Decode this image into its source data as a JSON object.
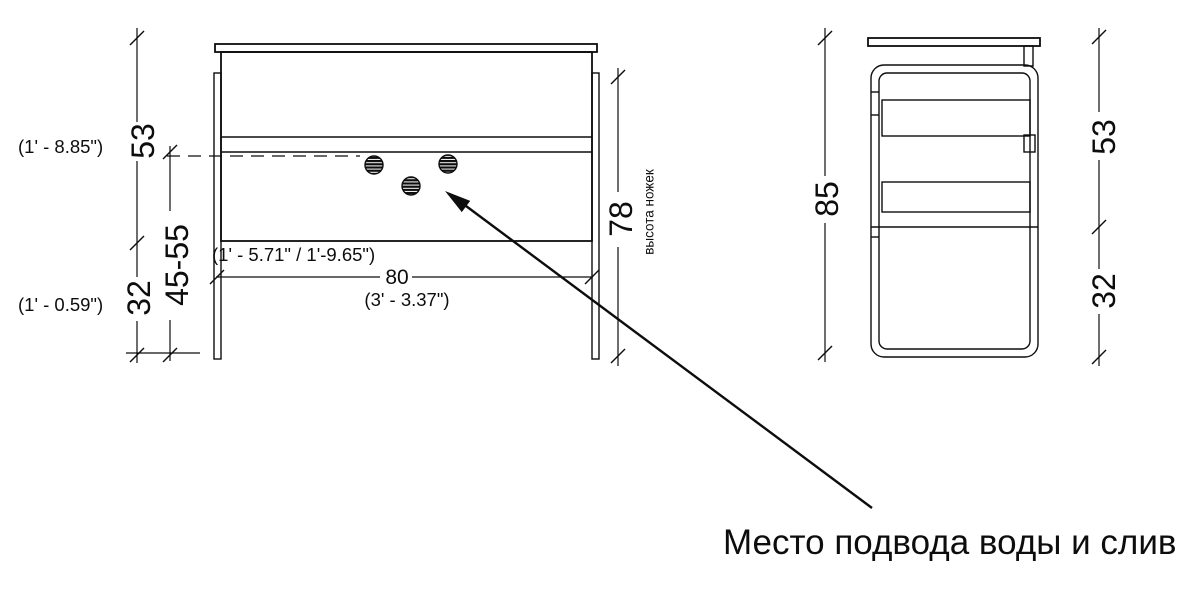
{
  "front_view": {
    "dim53": {
      "metric": "53",
      "imperial": "(1' - 8.85\")"
    },
    "dim4555": {
      "metric": "45-55",
      "imperial": "(1' - 5.71\" / 1'-9.65\")"
    },
    "dim32": {
      "metric": "32",
      "imperial": "(1' - 0.59\")"
    },
    "dim78": {
      "metric": "78",
      "note": "высота ножек"
    },
    "dim80": {
      "metric": "80",
      "imperial": "(3' - 3.37\")"
    }
  },
  "side_view": {
    "dim85": "85",
    "dim53": "53",
    "dim32": "32"
  },
  "callout": {
    "text": "Место подвода воды и слив"
  },
  "colors": {
    "line": "#0d0d0d",
    "background": "#ffffff"
  }
}
